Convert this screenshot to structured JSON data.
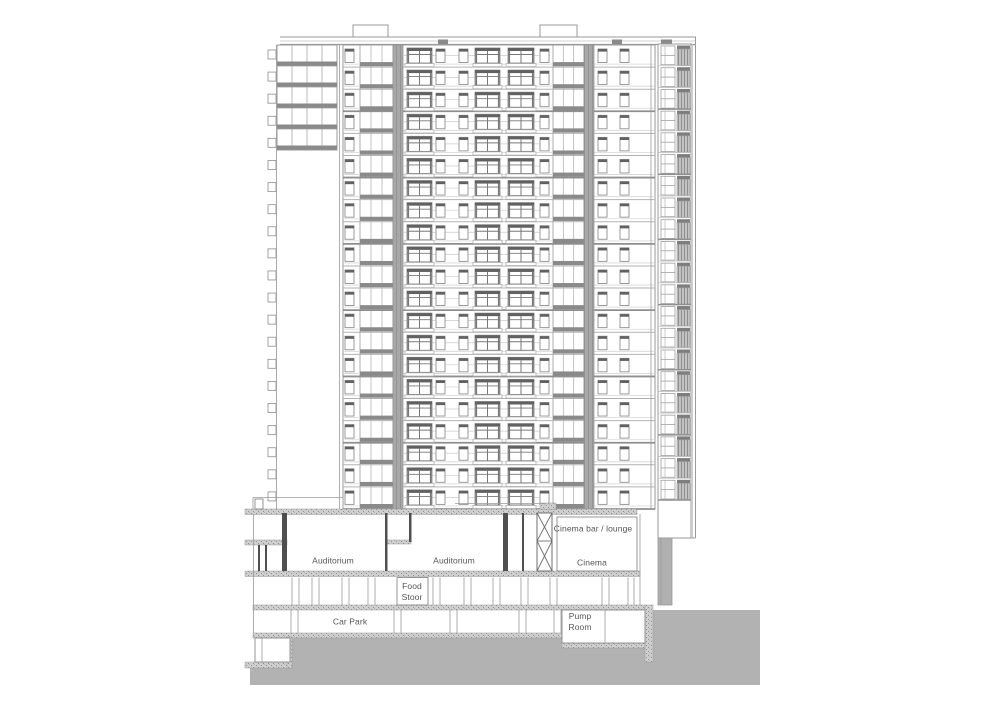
{
  "meta": {
    "drawing_type": "architectural building section",
    "width": 1000,
    "height": 702
  },
  "labels": {
    "auditorium_1": "Auditorium",
    "auditorium_2": "Auditorium",
    "cinema_bar": "Cinema bar / lounge",
    "cinema": "Cinema",
    "food_store": "Food\nStoor",
    "car_park": "Car Park",
    "pump_room": "Pump\nRoom"
  },
  "label_positions": {
    "auditorium_1": {
      "x": 333,
      "y": 561
    },
    "auditorium_2": {
      "x": 454,
      "y": 561
    },
    "cinema_bar": {
      "x": 593,
      "y": 529
    },
    "cinema": {
      "x": 592,
      "y": 563
    },
    "food_store": {
      "x": 412,
      "y": 592
    },
    "car_park": {
      "x": 350,
      "y": 622
    },
    "pump_room": {
      "x": 580,
      "y": 622
    }
  },
  "colors": {
    "background": "#ffffff",
    "line_light": "#c8c8c8",
    "line_mid": "#9a9a9a",
    "line_dark": "#6f6f6f",
    "wall_dark": "#4f4f4f",
    "window_header": "#616161",
    "spandrel": "#8a8a8a",
    "pier_base": "#a8a8a8",
    "pier_line": "#949494",
    "ground_fill": "#b2b2b2",
    "hatch_base": "#cfcfcf",
    "hatch_dot": "#8f8f8f",
    "text": "#555555"
  },
  "tower": {
    "floors": 21,
    "top": 45,
    "bottom": 509,
    "left": 343,
    "right": 655,
    "parapet": {
      "x1": 280,
      "x2": 696,
      "y1": 37,
      "y2": 41,
      "y3": 44.5
    },
    "bulkheads": [
      {
        "x": 353,
        "w": 35
      },
      {
        "x": 540,
        "w": 37
      }
    ],
    "roof_vents": [
      {
        "x": 438,
        "w": 10
      },
      {
        "x": 612,
        "w": 10
      },
      {
        "x": 661,
        "w": 11
      }
    ],
    "piers": [
      {
        "x": 393,
        "w": 10
      },
      {
        "x": 584,
        "w": 10
      }
    ],
    "narrow_windows_x": [
      345,
      436,
      459,
      540,
      598,
      620
    ],
    "balcony_windows": [
      {
        "x": 407,
        "w": 25
      },
      {
        "x": 475,
        "w": 25
      },
      {
        "x": 508,
        "w": 26
      }
    ],
    "grid_sections": [
      {
        "x": 360,
        "w": 33,
        "cols": 3
      },
      {
        "x": 553,
        "w": 31,
        "cols": 3
      }
    ],
    "left_wing": {
      "left": 277,
      "right": 337,
      "top": 45,
      "bottom": 150,
      "floors": 5,
      "cols": 4
    },
    "tick_strip": {
      "x": 268,
      "w": 8,
      "line_x": 276.5
    },
    "right_strip": {
      "left": 658,
      "right": 691,
      "top": 44,
      "plain_from": 500,
      "bottom": 538,
      "cell_x": 661,
      "cell_w": 14,
      "louvre_x": 677,
      "louvre_w": 13
    },
    "right_edge": {
      "x1": 692.5,
      "x2": 695.5,
      "ytop": 37,
      "ybottom": 538
    },
    "gray_column": {
      "x": 658,
      "w": 14,
      "y": 538,
      "h": 67
    }
  },
  "podium": {
    "ground": [
      {
        "x": 653,
        "y": 610,
        "w": 107,
        "h": 75
      },
      {
        "x": 290,
        "y": 637,
        "w": 363,
        "h": 48
      },
      {
        "x": 250,
        "y": 668,
        "w": 40,
        "h": 17
      }
    ],
    "hatched_slabs": [
      {
        "x": 245,
        "y": 509,
        "w": 392,
        "h": 5.5
      },
      {
        "x": 540,
        "y": 503,
        "w": 16,
        "h": 6.5
      },
      {
        "x": 245,
        "y": 540,
        "w": 42,
        "h": 5
      },
      {
        "x": 387,
        "y": 540,
        "w": 24,
        "h": 4
      },
      {
        "x": 558,
        "y": 541,
        "w": 49,
        "h": 4
      },
      {
        "x": 245,
        "y": 571,
        "w": 395,
        "h": 5.5
      },
      {
        "x": 253,
        "y": 605,
        "w": 392,
        "h": 5
      },
      {
        "x": 645,
        "y": 605,
        "w": 8,
        "h": 57
      },
      {
        "x": 253,
        "y": 633,
        "w": 311,
        "h": 5
      },
      {
        "x": 562,
        "y": 643,
        "w": 83,
        "h": 5
      },
      {
        "x": 245,
        "y": 662,
        "w": 47,
        "h": 6
      },
      {
        "x": 287,
        "y": 637,
        "w": 5,
        "h": 31
      }
    ],
    "dark_walls": [
      {
        "x": 282,
        "y": 513,
        "w": 5,
        "h": 58
      },
      {
        "x": 385,
        "y": 513,
        "w": 2.5,
        "h": 58
      },
      {
        "x": 409,
        "y": 513,
        "w": 2.5,
        "h": 29
      },
      {
        "x": 503,
        "y": 513,
        "w": 5,
        "h": 58
      },
      {
        "x": 522,
        "y": 513,
        "w": 2,
        "h": 58
      },
      {
        "x": 258,
        "y": 545,
        "w": 2,
        "h": 26
      },
      {
        "x": 265,
        "y": 545,
        "w": 2,
        "h": 26
      }
    ],
    "white_rooms": [
      {
        "x": 557,
        "y": 517,
        "w": 80,
        "h": 54
      },
      {
        "x": 562,
        "y": 610,
        "w": 83,
        "h": 33
      },
      {
        "x": 397,
        "y": 577.5,
        "w": 31,
        "h": 27.5
      },
      {
        "x": 255,
        "y": 638,
        "w": 35,
        "h": 24
      },
      {
        "x": 255,
        "y": 499,
        "w": 8,
        "h": 10
      }
    ],
    "xbrace": {
      "x": 537,
      "y": 513,
      "w": 15,
      "h1": 28,
      "h2": 30
    },
    "thin_columns": [
      {
        "y1": 577.5,
        "y2": 605,
        "xs": [
          292,
          299,
          312,
          319,
          342,
          349,
          368,
          375,
          433,
          440,
          464,
          471,
          493,
          500,
          521,
          528,
          550,
          557,
          602,
          609,
          628,
          634
        ]
      },
      {
        "y1": 610,
        "y2": 633,
        "xs": [
          291,
          298,
          394,
          401,
          450,
          457,
          519,
          526,
          554,
          561
        ]
      },
      {
        "y1": 638,
        "y2": 662,
        "xs": [
          262
        ]
      }
    ],
    "lines": [
      {
        "x1": 253,
        "y1": 497.5,
        "x2": 343,
        "y2": 497.5
      },
      {
        "x1": 253,
        "y1": 497.5,
        "x2": 253,
        "y2": 509
      },
      {
        "x1": 455,
        "y1": 503.5,
        "x2": 546,
        "y2": 503.5
      },
      {
        "x1": 605,
        "y1": 610,
        "x2": 605,
        "y2": 643
      },
      {
        "x1": 253.5,
        "y1": 514,
        "x2": 253.5,
        "y2": 633
      },
      {
        "x1": 640,
        "y1": 514,
        "x2": 640,
        "y2": 605
      },
      {
        "x1": 339.5,
        "y1": 45,
        "x2": 339.5,
        "y2": 509
      },
      {
        "x1": 651,
        "y1": 45,
        "x2": 651,
        "y2": 509
      }
    ]
  }
}
